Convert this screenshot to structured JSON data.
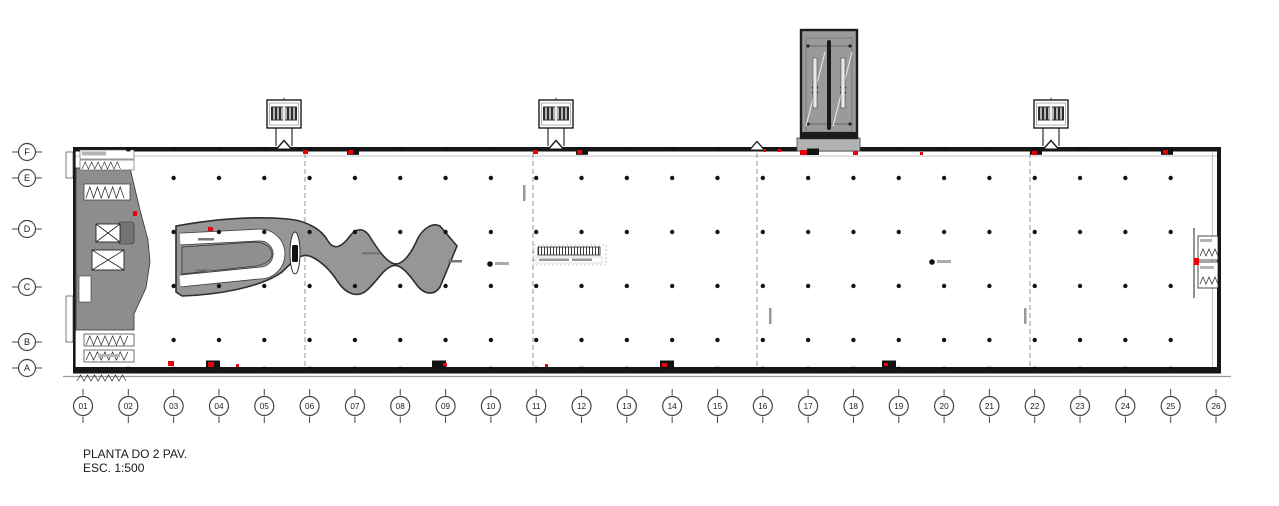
{
  "title": {
    "line1": "PLANTA DO 2 PAV.",
    "line2": "ESC. 1:500"
  },
  "grid": {
    "row_labels": [
      "F",
      "E",
      "D",
      "C",
      "B",
      "A"
    ],
    "row_y": [
      152,
      178,
      229,
      287,
      342,
      368
    ],
    "column_labels": [
      "01",
      "02",
      "03",
      "04",
      "05",
      "06",
      "07",
      "08",
      "09",
      "10",
      "11",
      "12",
      "13",
      "14",
      "15",
      "16",
      "17",
      "18",
      "19",
      "20",
      "21",
      "22",
      "23",
      "24",
      "25",
      "26"
    ],
    "column_x_start": 83,
    "column_spacing": 45.32,
    "column_circle_y": 406
  },
  "plan": {
    "colors": {
      "wall": "#161616",
      "core_gray": "#8d8d8d",
      "ramp_gray": "#969696",
      "tower_gray": "#9a9a9a",
      "red": "#e8000d",
      "dash_gray": "#7d7d7d",
      "smudge_gray": "#9b9b9b"
    },
    "interior_dot_rows_y": [
      178,
      232,
      286,
      340
    ],
    "interior_dot_column_range": [
      3,
      25
    ],
    "wall_stud_column_range": [
      2,
      25
    ],
    "joint_lines_x": [
      305,
      533,
      757,
      1030
    ],
    "joint_chevron_x": 757,
    "stair_pavilions_x": [
      284,
      556,
      1051
    ],
    "equipment_boxes_top_x": [
      347,
      576,
      1030,
      1161
    ],
    "equipment_boxes_bottom_x": [
      206,
      432,
      660,
      882
    ],
    "section_markers": [
      [
        490,
        264
      ],
      [
        932,
        262
      ]
    ],
    "red_marks": [
      [
        303,
        150,
        5,
        4
      ],
      [
        348,
        150,
        5,
        4
      ],
      [
        533,
        150,
        5,
        4
      ],
      [
        577,
        150,
        5,
        4
      ],
      [
        763,
        149,
        3,
        3
      ],
      [
        778,
        149,
        3,
        3
      ],
      [
        800,
        150,
        7,
        5
      ],
      [
        853,
        151,
        5,
        4
      ],
      [
        920,
        152,
        3,
        3
      ],
      [
        1032,
        151,
        5,
        4
      ],
      [
        1163,
        150,
        5,
        4
      ],
      [
        208,
        227,
        5,
        4
      ],
      [
        133,
        211,
        4,
        5
      ],
      [
        1194,
        258,
        5,
        7
      ],
      [
        168,
        361,
        6,
        5
      ],
      [
        208,
        362,
        6,
        5
      ],
      [
        236,
        364,
        3,
        3
      ],
      [
        443,
        363,
        4,
        3
      ],
      [
        545,
        364,
        3,
        3
      ],
      [
        662,
        363,
        5,
        4
      ],
      [
        884,
        363,
        4,
        3
      ]
    ]
  }
}
